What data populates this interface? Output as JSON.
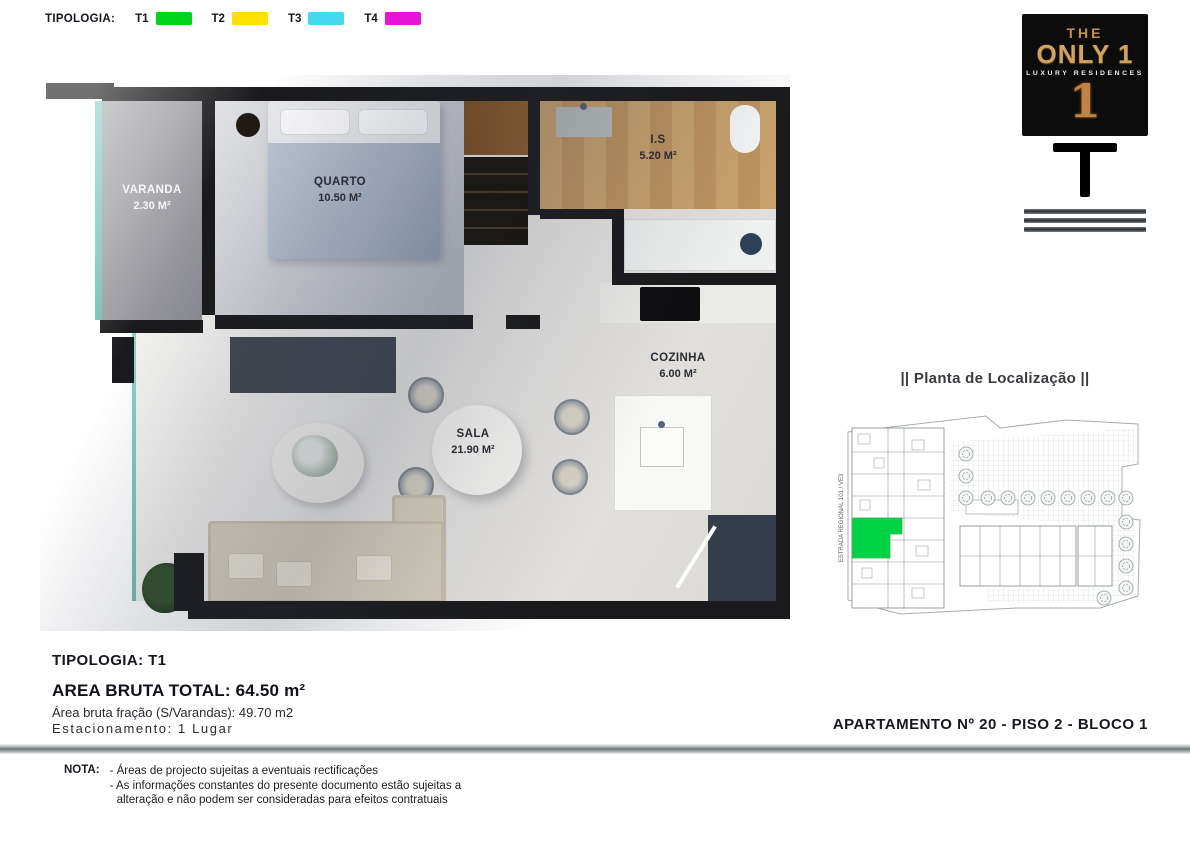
{
  "legend": {
    "title": "TIPOLOGIA:",
    "items": [
      {
        "label": "T1",
        "color": "#00d41c"
      },
      {
        "label": "T2",
        "color": "#ffdf00"
      },
      {
        "label": "T3",
        "color": "#45d9f0"
      },
      {
        "label": "T4",
        "color": "#e815d8"
      }
    ]
  },
  "logo": {
    "the": "THE",
    "only": "ONLY 1",
    "subtitle": "LUXURY RESIDENCES",
    "numeral": "1"
  },
  "floor_plan": {
    "rooms": [
      {
        "name": "VARANDA",
        "area": "2.30 M²"
      },
      {
        "name": "QUARTO",
        "area": "10.50 M²"
      },
      {
        "name": "I.S",
        "area": "5.20 M²"
      },
      {
        "name": "COZINHA",
        "area": "6.00 M²"
      },
      {
        "name": "SALA",
        "area": "21.90 M²"
      }
    ]
  },
  "site_plan": {
    "title": "|| Planta de Localização ||",
    "road_label": "ESTRADA REGIONAL 101 / VE3",
    "highlight_color": "#00d446"
  },
  "details": {
    "tipologia": "TIPOLOGIA: T1",
    "area_bruta": "AREA BRUTA TOTAL: 64.50 m²",
    "area_fracao": "Área bruta fração (S/Varandas): 49.70 m2",
    "estacionamento": "Estacionamento: 1 Lugar"
  },
  "apartment_label": "APARTAMENTO Nº  20 - PISO 2 - BLOCO 1",
  "note": {
    "label": "NOTA:",
    "lines": [
      "- Áreas de projecto sujeitas a eventuais rectificações",
      "- As informações constantes do presente documento estão sujeitas a",
      "alteração e não podem ser consideradas para efeitos contratuais"
    ]
  }
}
